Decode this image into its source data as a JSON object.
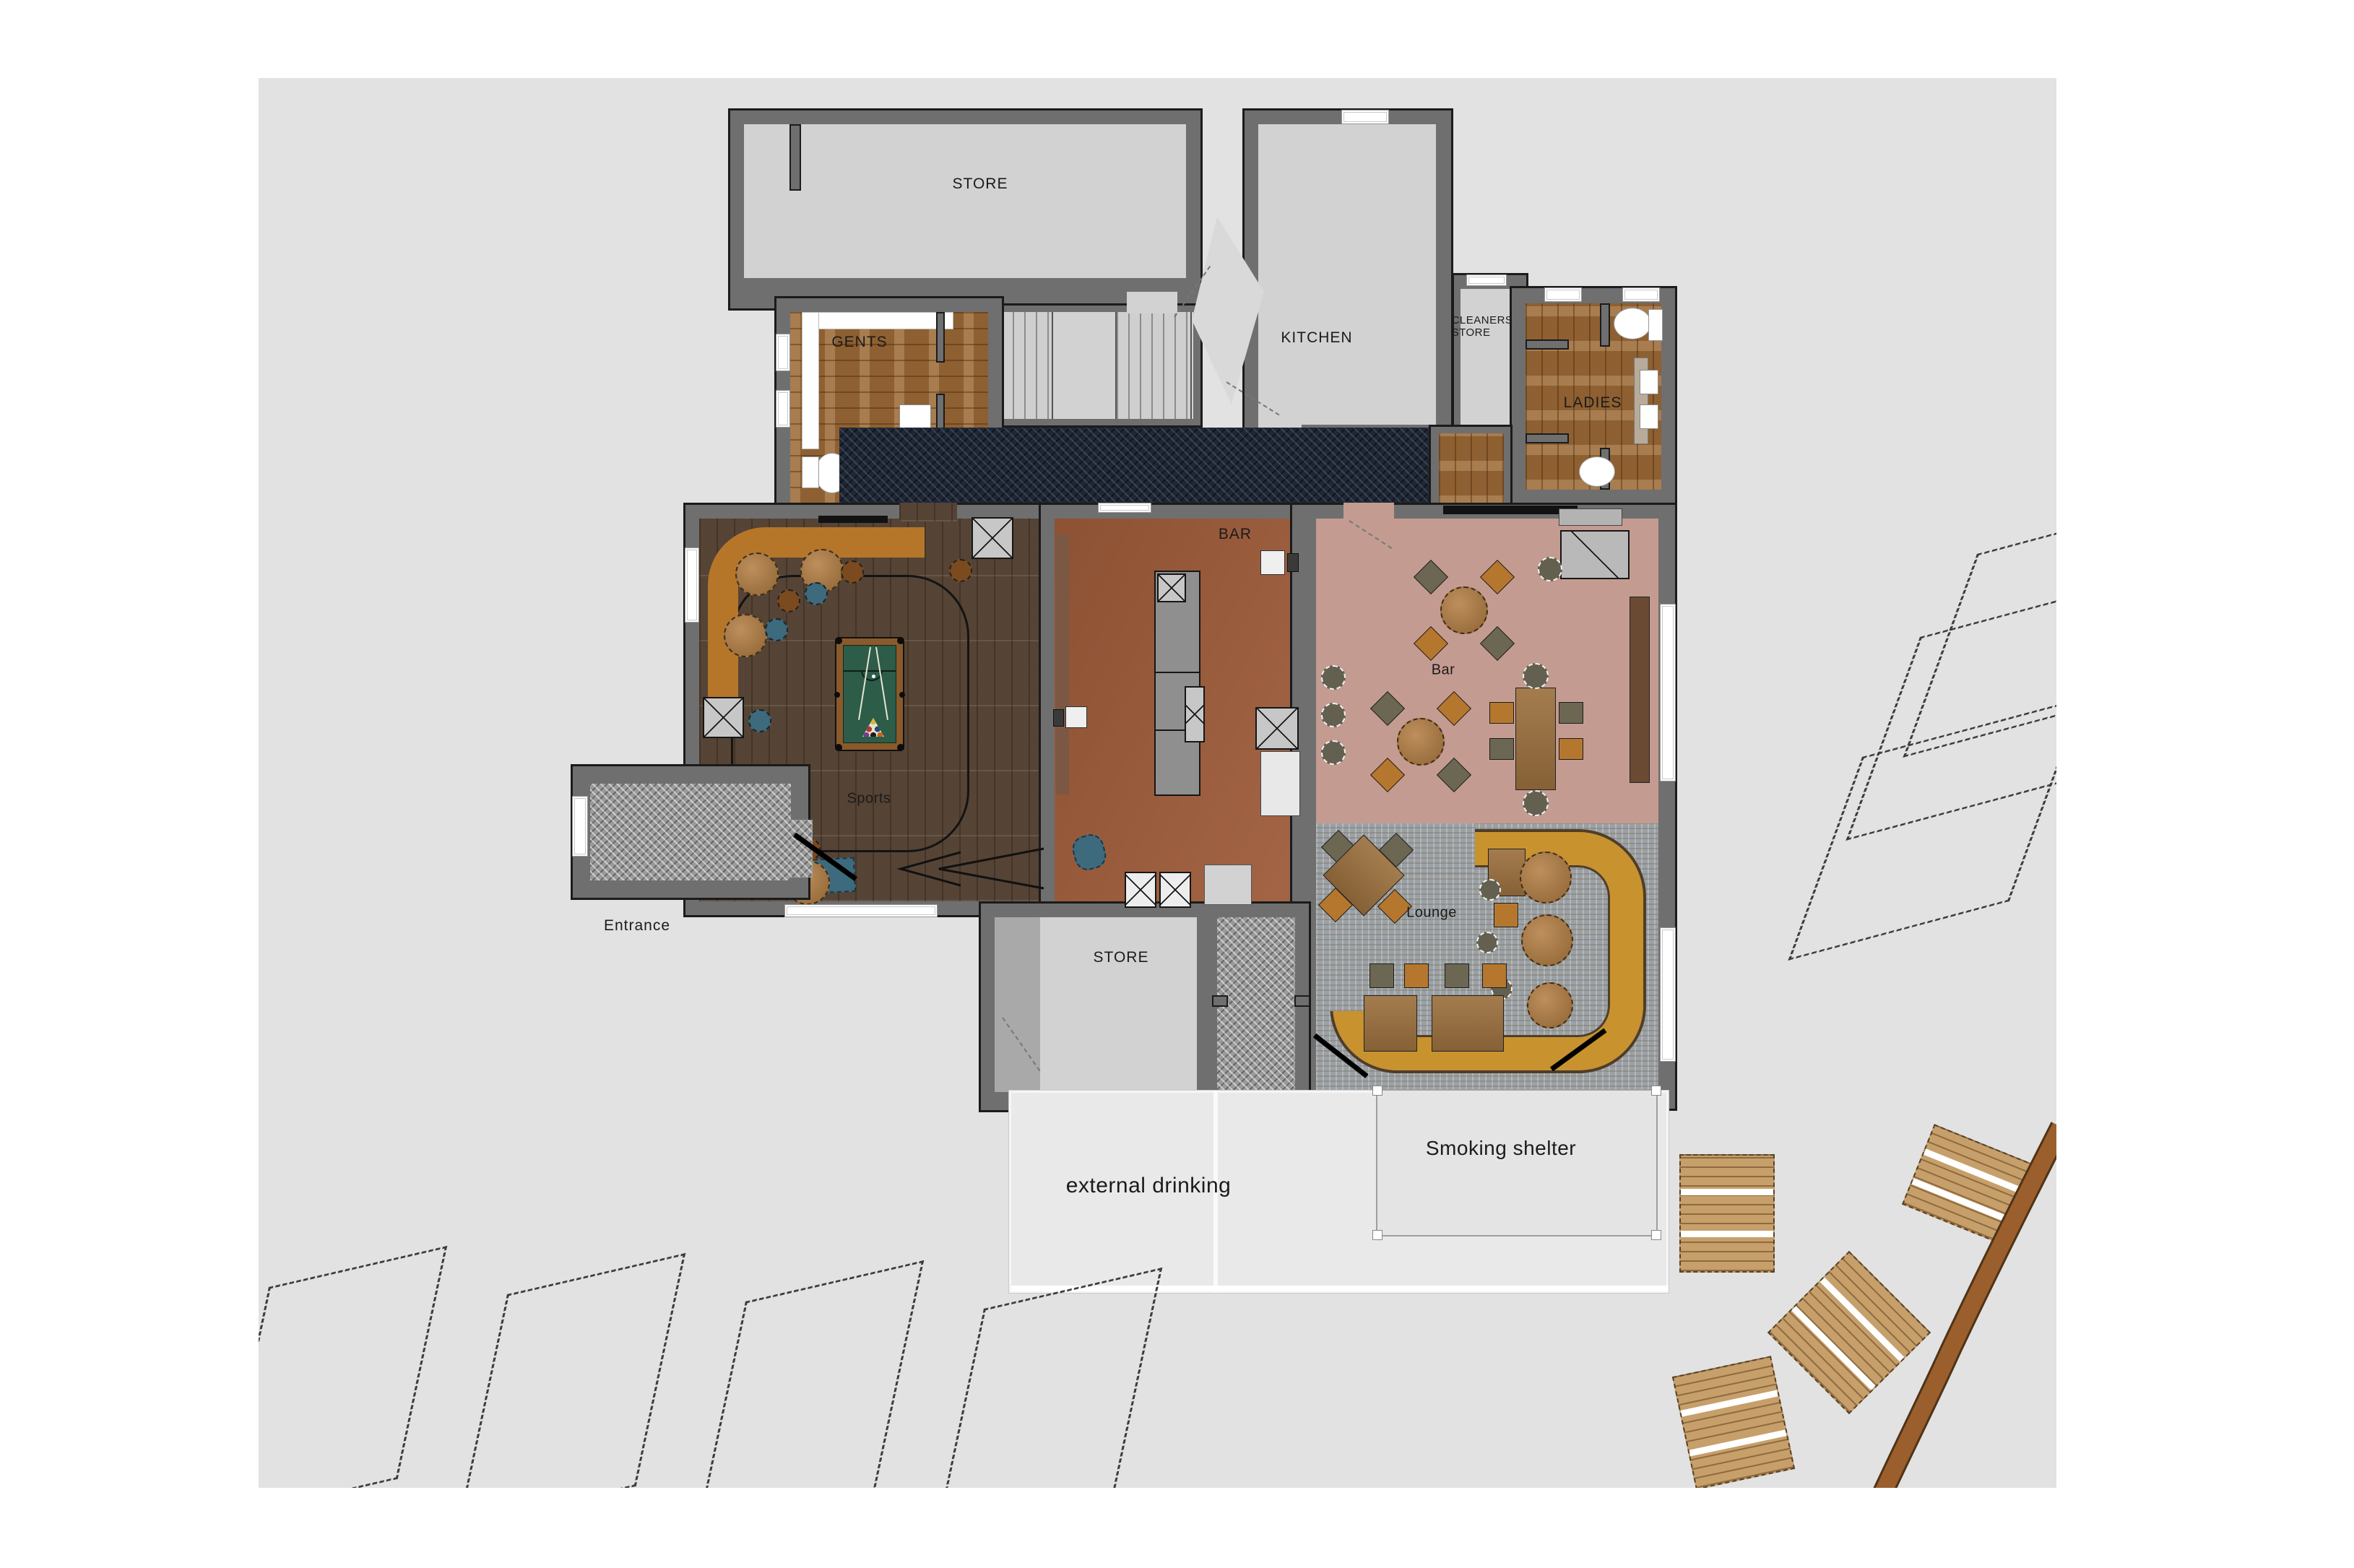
{
  "colors": {
    "canvas": "#e2e2e2",
    "wall": "#6f6f6f",
    "room_floor_light": "#d2d2d2",
    "wood_dark": "#5f4b3b",
    "wood_light": "#9c6c3a",
    "terracotta": "#9d5b39",
    "mauve": "#c49b91",
    "navy_carpet": "#1f2735",
    "gray_carpet": "#9a9a9a",
    "stone_carpet": "#9aa1a6",
    "gold": "#c8922e",
    "tan": "#b5762a",
    "pool_felt": "#2d5c49",
    "road": "#9a5f2c",
    "table_wood": "#9c713f",
    "chair_olive": "#6b6753",
    "chair_amber": "#b5772e",
    "stool_blue": "#3d6a7d",
    "picnic_wood": "#c69f6b"
  },
  "rooms": {
    "store_top": {
      "label": "STORE"
    },
    "kitchen": {
      "label": "KITCHEN"
    },
    "cleaners_store": {
      "label": "CLEANERS\nSTORE"
    },
    "gents": {
      "label": "GENTS"
    },
    "ladies": {
      "label": "LADIES"
    },
    "bar_servery": {
      "label": "BAR"
    },
    "bar_room": {
      "label": "Bar"
    },
    "sports": {
      "label": "Sports"
    },
    "lounge": {
      "label": "Lounge"
    },
    "entrance": {
      "label": "Entrance"
    },
    "store_bottom": {
      "label": "STORE"
    },
    "external_drinking": {
      "label": "external drinking"
    },
    "smoking_shelter": {
      "label": "Smoking shelter"
    }
  }
}
